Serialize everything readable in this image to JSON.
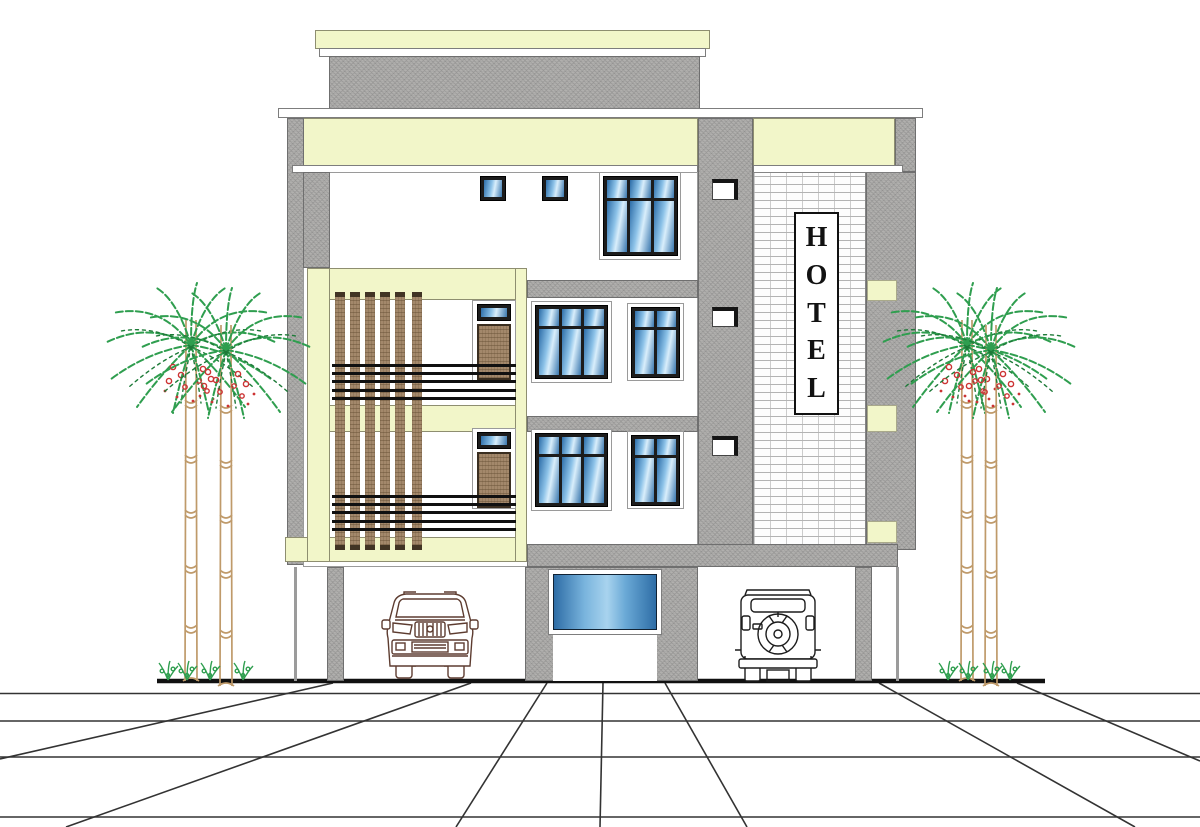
{
  "sign": {
    "text": "HOTEL",
    "letters": [
      "H",
      "O",
      "T",
      "E",
      "L"
    ]
  },
  "scene": {
    "floors_above_ground": 2,
    "palm_trees": 4,
    "vehicles": 2,
    "vehicle_icons": [
      "suv-front-icon",
      "jeep-rear-icon"
    ]
  },
  "colors": {
    "band_cream": "#f2f6c9",
    "concrete_gray": "#b1b0ae",
    "brick_white": "#fdfdfd",
    "glass_blue_dark": "#2d6da8",
    "glass_blue_light": "#d9eefb",
    "wood_brown": "#a3886b",
    "sign_letter": "#121212",
    "palm_green": "#2f9e4f",
    "palm_trunk": "#bf9a6a",
    "berry_red": "#cc3333",
    "ground_line": "#111111"
  }
}
